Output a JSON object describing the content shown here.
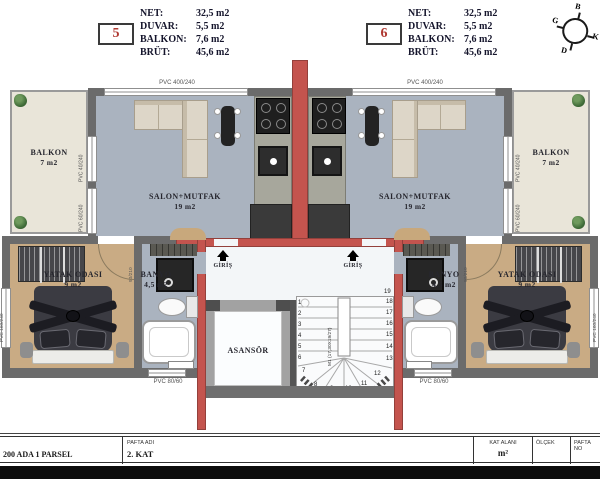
{
  "header": {
    "unit_left": {
      "number": "5",
      "rows": [
        {
          "label": "NET:",
          "value": "32,5 m2"
        },
        {
          "label": "DUVAR:",
          "value": "5,5 m2"
        },
        {
          "label": "BALKON:",
          "value": "7,6 m2"
        },
        {
          "label": "BRÜT:",
          "value": "45,6 m2"
        }
      ]
    },
    "unit_right": {
      "number": "6",
      "rows": [
        {
          "label": "NET:",
          "value": "32,5 m2"
        },
        {
          "label": "DUVAR:",
          "value": "5,5 m2"
        },
        {
          "label": "BALKON:",
          "value": "7,6 m2"
        },
        {
          "label": "BRÜT:",
          "value": "45,6 m2"
        }
      ]
    },
    "compass": {
      "top": "B",
      "right": "K",
      "bottom": "D",
      "left": "G"
    }
  },
  "plan": {
    "left_unit": {
      "balkon": {
        "name": "BALKON",
        "area": "7 m2"
      },
      "salon": {
        "name": "SALON+MUTFAK",
        "area": "19 m2"
      },
      "yatak": {
        "name": "YATAK ODASI",
        "area": "9 m2"
      },
      "banyo": {
        "name": "BANYO",
        "area": "4,5 m2"
      },
      "giris": "GİRİŞ"
    },
    "right_unit": {
      "balkon": {
        "name": "BALKON",
        "area": "7 m2"
      },
      "salon": {
        "name": "SALON+MUTFAK",
        "area": "19 m2"
      },
      "yatak": {
        "name": "YATAK ODASI",
        "area": "9 m2"
      },
      "banyo": {
        "name": "BANYO",
        "area": "4,5 m2"
      },
      "giris": "GİRİŞ"
    },
    "core": {
      "asansor": "ASANSÖR",
      "stair_label": "M1 (17,30X19/27)",
      "stair_numbers": [
        "1",
        "2",
        "3",
        "4",
        "5",
        "6",
        "7",
        "8",
        "9",
        "10",
        "11",
        "12",
        "13",
        "14",
        "15",
        "16",
        "17",
        "18",
        "19"
      ]
    },
    "windows": {
      "top": "PVC 400/240",
      "balcony_upper": "PVC 40/240",
      "balcony_lower": "PVC 60/240",
      "bedroom_side": "PVC 160/240",
      "bath_bottom": "PVC 80/60",
      "bedroom_door": "90/210"
    }
  },
  "titleblock": {
    "parsel": "200 ADA 1 PARSEL",
    "pafta_adi_label": "PAFTA ADI",
    "pafta_adi_value": "2. KAT",
    "kat_alani_label": "KAT ALANI",
    "kat_alani_value": "m²",
    "olcek_label": "ÖLÇEK",
    "pafta_no_label": "PAFTA NO"
  },
  "colors": {
    "red_wall": "#c4544e",
    "wall_gray": "#6b6b6b",
    "floor_salon": "#aab3bf",
    "floor_bedroom": "#c9ab84",
    "floor_balcony": "#e9e5d9",
    "floor_core": "#f3f6f8",
    "unit_number": "#b03a33"
  }
}
